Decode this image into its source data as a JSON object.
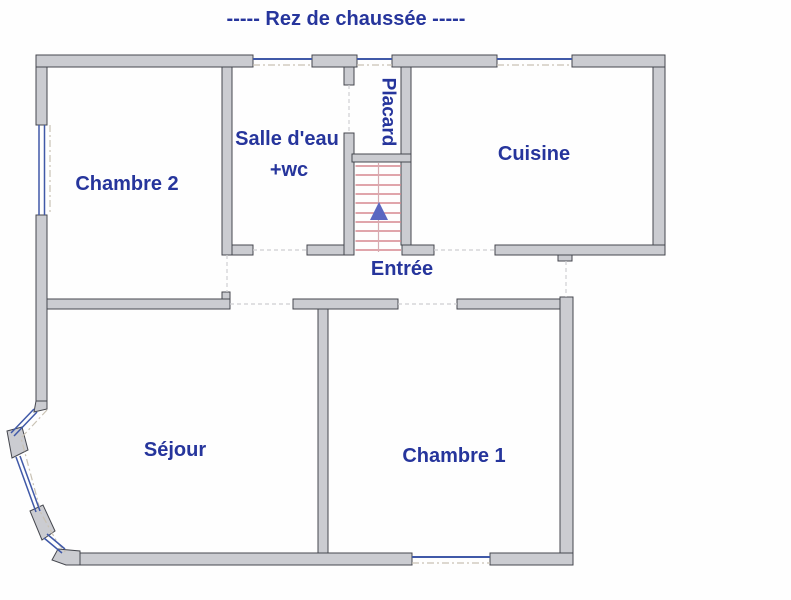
{
  "title": "-----  Rez de chaussée  -----",
  "floor_plan": {
    "rooms": [
      {
        "name": "chambre-2",
        "label": "Chambre 2"
      },
      {
        "name": "salle-deau",
        "label": "Salle d'eau",
        "label2": "+wc"
      },
      {
        "name": "placard",
        "label": "Placard"
      },
      {
        "name": "cuisine",
        "label": "Cuisine"
      },
      {
        "name": "entree",
        "label": "Entrée"
      },
      {
        "name": "sejour",
        "label": "Séjour"
      },
      {
        "name": "chambre-1",
        "label": "Chambre 1"
      }
    ],
    "stair": {
      "direction": "up",
      "icon": "up-arrow-icon"
    },
    "colors": {
      "title_text": "#26359c",
      "label_text": "#26359c",
      "wall_fill": "#cbccd1",
      "wall_stroke": "#45474e",
      "window_blue": "#4059a8",
      "stair_tread": "#d5878f",
      "stair_arrow": "#5b67c1"
    }
  }
}
